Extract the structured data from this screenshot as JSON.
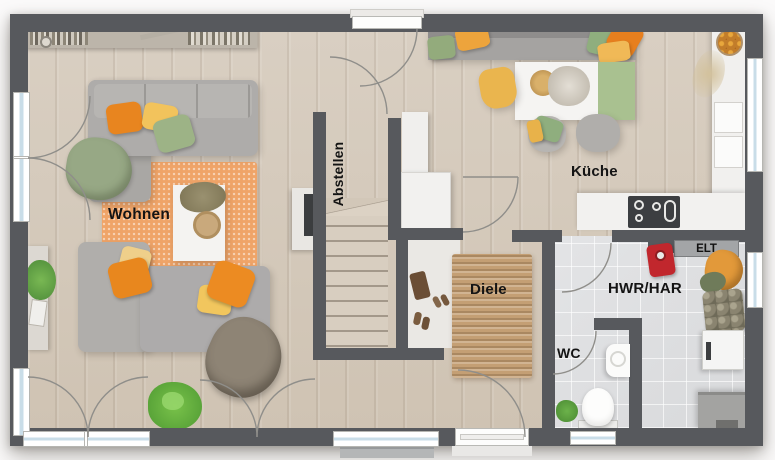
{
  "rooms": {
    "wohnen": {
      "label": "Wohnen"
    },
    "abstellen": {
      "label": "Abstellen"
    },
    "kueche": {
      "label": "Küche"
    },
    "diele": {
      "label": "Diele"
    },
    "wc": {
      "label": "WC"
    },
    "hwr": {
      "label": "HWR/HAR"
    }
  },
  "annotations": {
    "elt": {
      "label": "ELT"
    }
  },
  "colors": {
    "wall": "#57595d",
    "wood_floor": "#d5cabc",
    "tile_floor": "#dfe0e2",
    "living_rug": "#efa468",
    "hall_rug": "#c49f74",
    "accent_orange": "#e8851f",
    "accent_yellow": "#f2c35c",
    "accent_green": "#9db386"
  }
}
